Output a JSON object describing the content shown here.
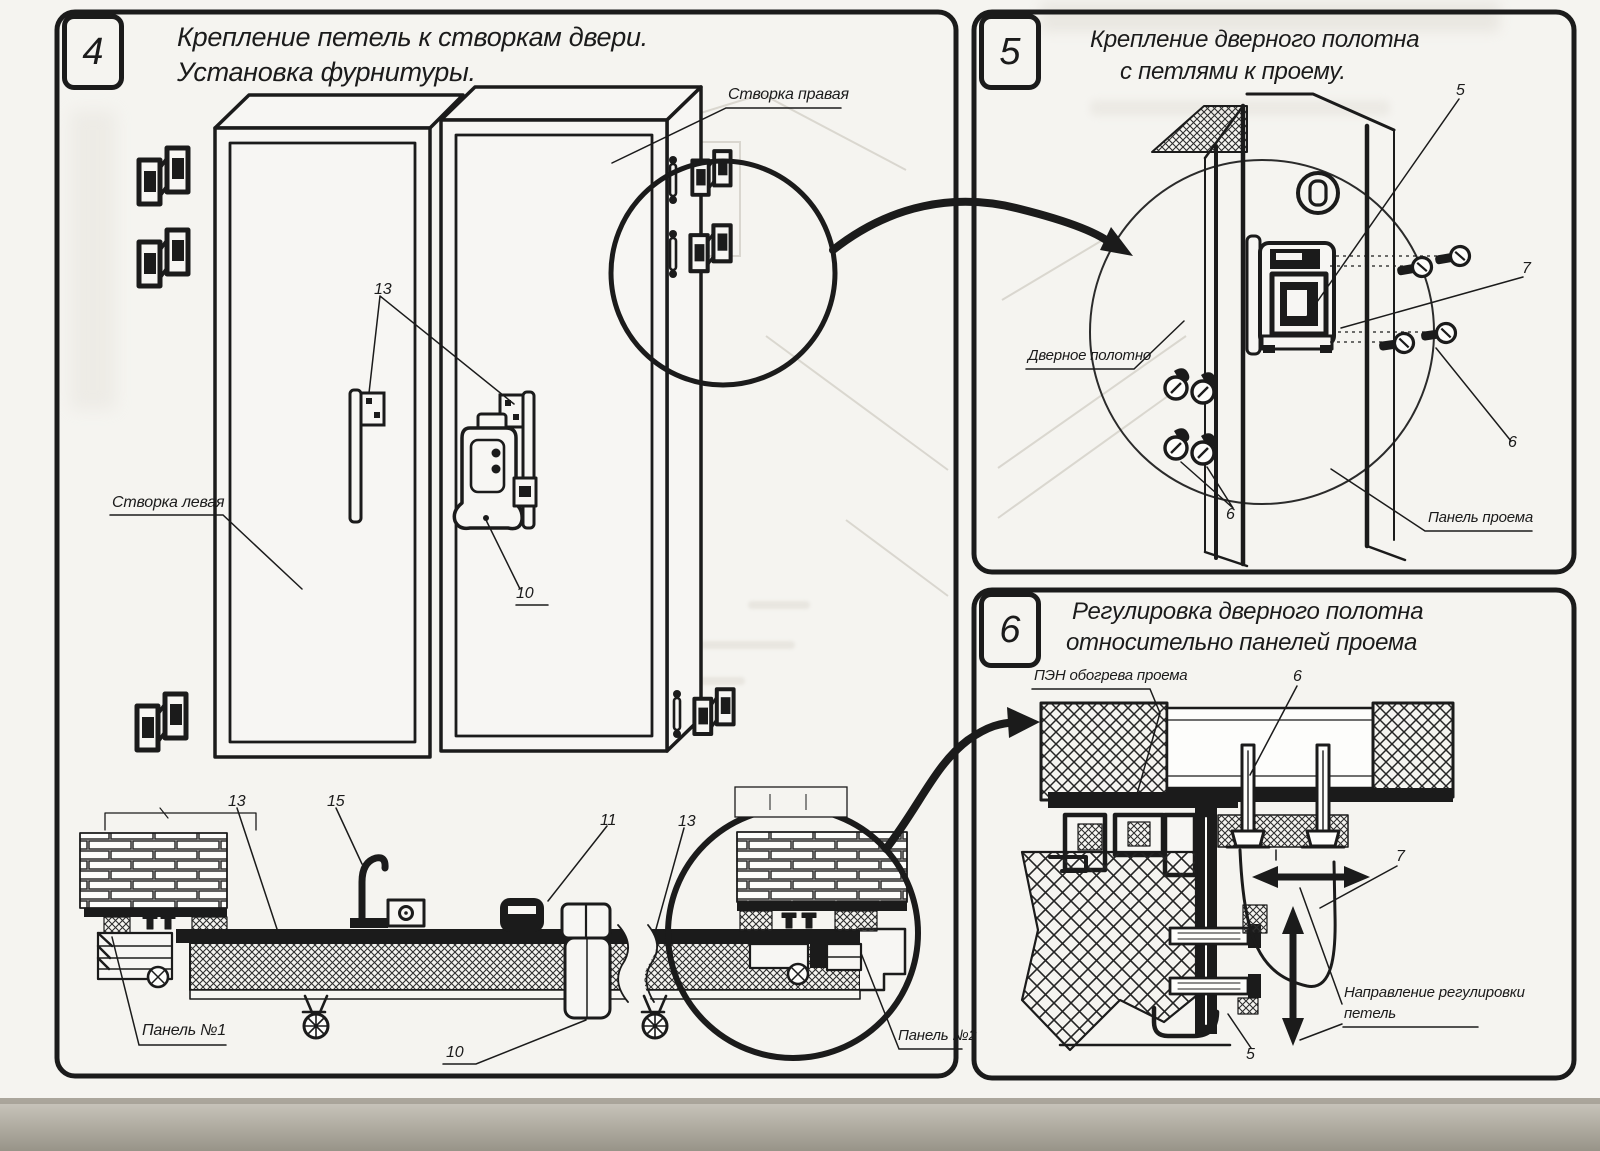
{
  "page": {
    "colors": {
      "ink": "#1b1b1b",
      "paper": "#f5f4f0",
      "door_face": "#f7f6f3",
      "photo_edge": "#9a968c"
    }
  },
  "panels": [
    {
      "number": "4",
      "title_lines": [
        "Крепление петель к створкам двери.",
        "Установка фурнитуры."
      ]
    },
    {
      "number": "5",
      "title_lines": [
        "Крепление дверного полотна",
        "с петлями к проему."
      ]
    },
    {
      "number": "6",
      "title_lines": [
        "Регулировка дверного полотна",
        "относительно панелей проема"
      ]
    }
  ],
  "callouts": [
    {
      "name": "label-stvorka-pravaya",
      "text": "Створка правая",
      "x": 728,
      "y": 86,
      "fs": 16
    },
    {
      "name": "label-stvorka-levaya",
      "text": "Створка левая",
      "x": 112,
      "y": 494,
      "fs": 16
    },
    {
      "name": "callout-13-doors",
      "text": "13",
      "x": 374,
      "y": 281,
      "fs": 16
    },
    {
      "name": "callout-10-lock",
      "text": "10",
      "x": 516,
      "y": 585,
      "fs": 16
    },
    {
      "name": "callout-13-section-left",
      "text": "13",
      "x": 228,
      "y": 793,
      "fs": 16
    },
    {
      "name": "callout-15-section",
      "text": "15",
      "x": 327,
      "y": 793,
      "fs": 16
    },
    {
      "name": "callout-11-section",
      "text": "11",
      "x": 600,
      "y": 812,
      "fs": 16
    },
    {
      "name": "callout-13-section-right",
      "text": "13",
      "x": 678,
      "y": 813,
      "fs": 16
    },
    {
      "name": "label-panel-n1",
      "text": "Панель №1",
      "x": 142,
      "y": 1022,
      "fs": 16
    },
    {
      "name": "callout-10-section",
      "text": "10",
      "x": 446,
      "y": 1044,
      "fs": 16
    },
    {
      "name": "label-panel-n2",
      "text": "Панель №2",
      "x": 898,
      "y": 1027,
      "fs": 15
    },
    {
      "name": "label-dvernoe-polotno",
      "text": "Дверное полотно",
      "x": 1028,
      "y": 347,
      "fs": 15
    },
    {
      "name": "label-panel-proema",
      "text": "Панель проема",
      "x": 1428,
      "y": 509,
      "fs": 15
    },
    {
      "name": "callout-5-p5",
      "text": "5",
      "x": 1456,
      "y": 82,
      "fs": 16
    },
    {
      "name": "callout-7-p5",
      "text": "7",
      "x": 1522,
      "y": 260,
      "fs": 16
    },
    {
      "name": "callout-6-p5-right",
      "text": "6",
      "x": 1508,
      "y": 434,
      "fs": 16
    },
    {
      "name": "callout-6-p5-left",
      "text": "6",
      "x": 1226,
      "y": 506,
      "fs": 16
    },
    {
      "name": "label-pen-obogreva",
      "text": "ПЭН обогрева проема",
      "x": 1034,
      "y": 667,
      "fs": 15
    },
    {
      "name": "callout-6-p6",
      "text": "6",
      "x": 1293,
      "y": 668,
      "fs": 16
    },
    {
      "name": "callout-7-p6",
      "text": "7",
      "x": 1396,
      "y": 848,
      "fs": 16
    },
    {
      "name": "label-napravlenie-1",
      "text": "Направление регулировки",
      "x": 1344,
      "y": 984,
      "fs": 15
    },
    {
      "name": "label-napravlenie-2",
      "text": "петель",
      "x": 1344,
      "y": 1005,
      "fs": 15
    },
    {
      "name": "callout-5-p6",
      "text": "5",
      "x": 1246,
      "y": 1046,
      "fs": 16
    }
  ]
}
